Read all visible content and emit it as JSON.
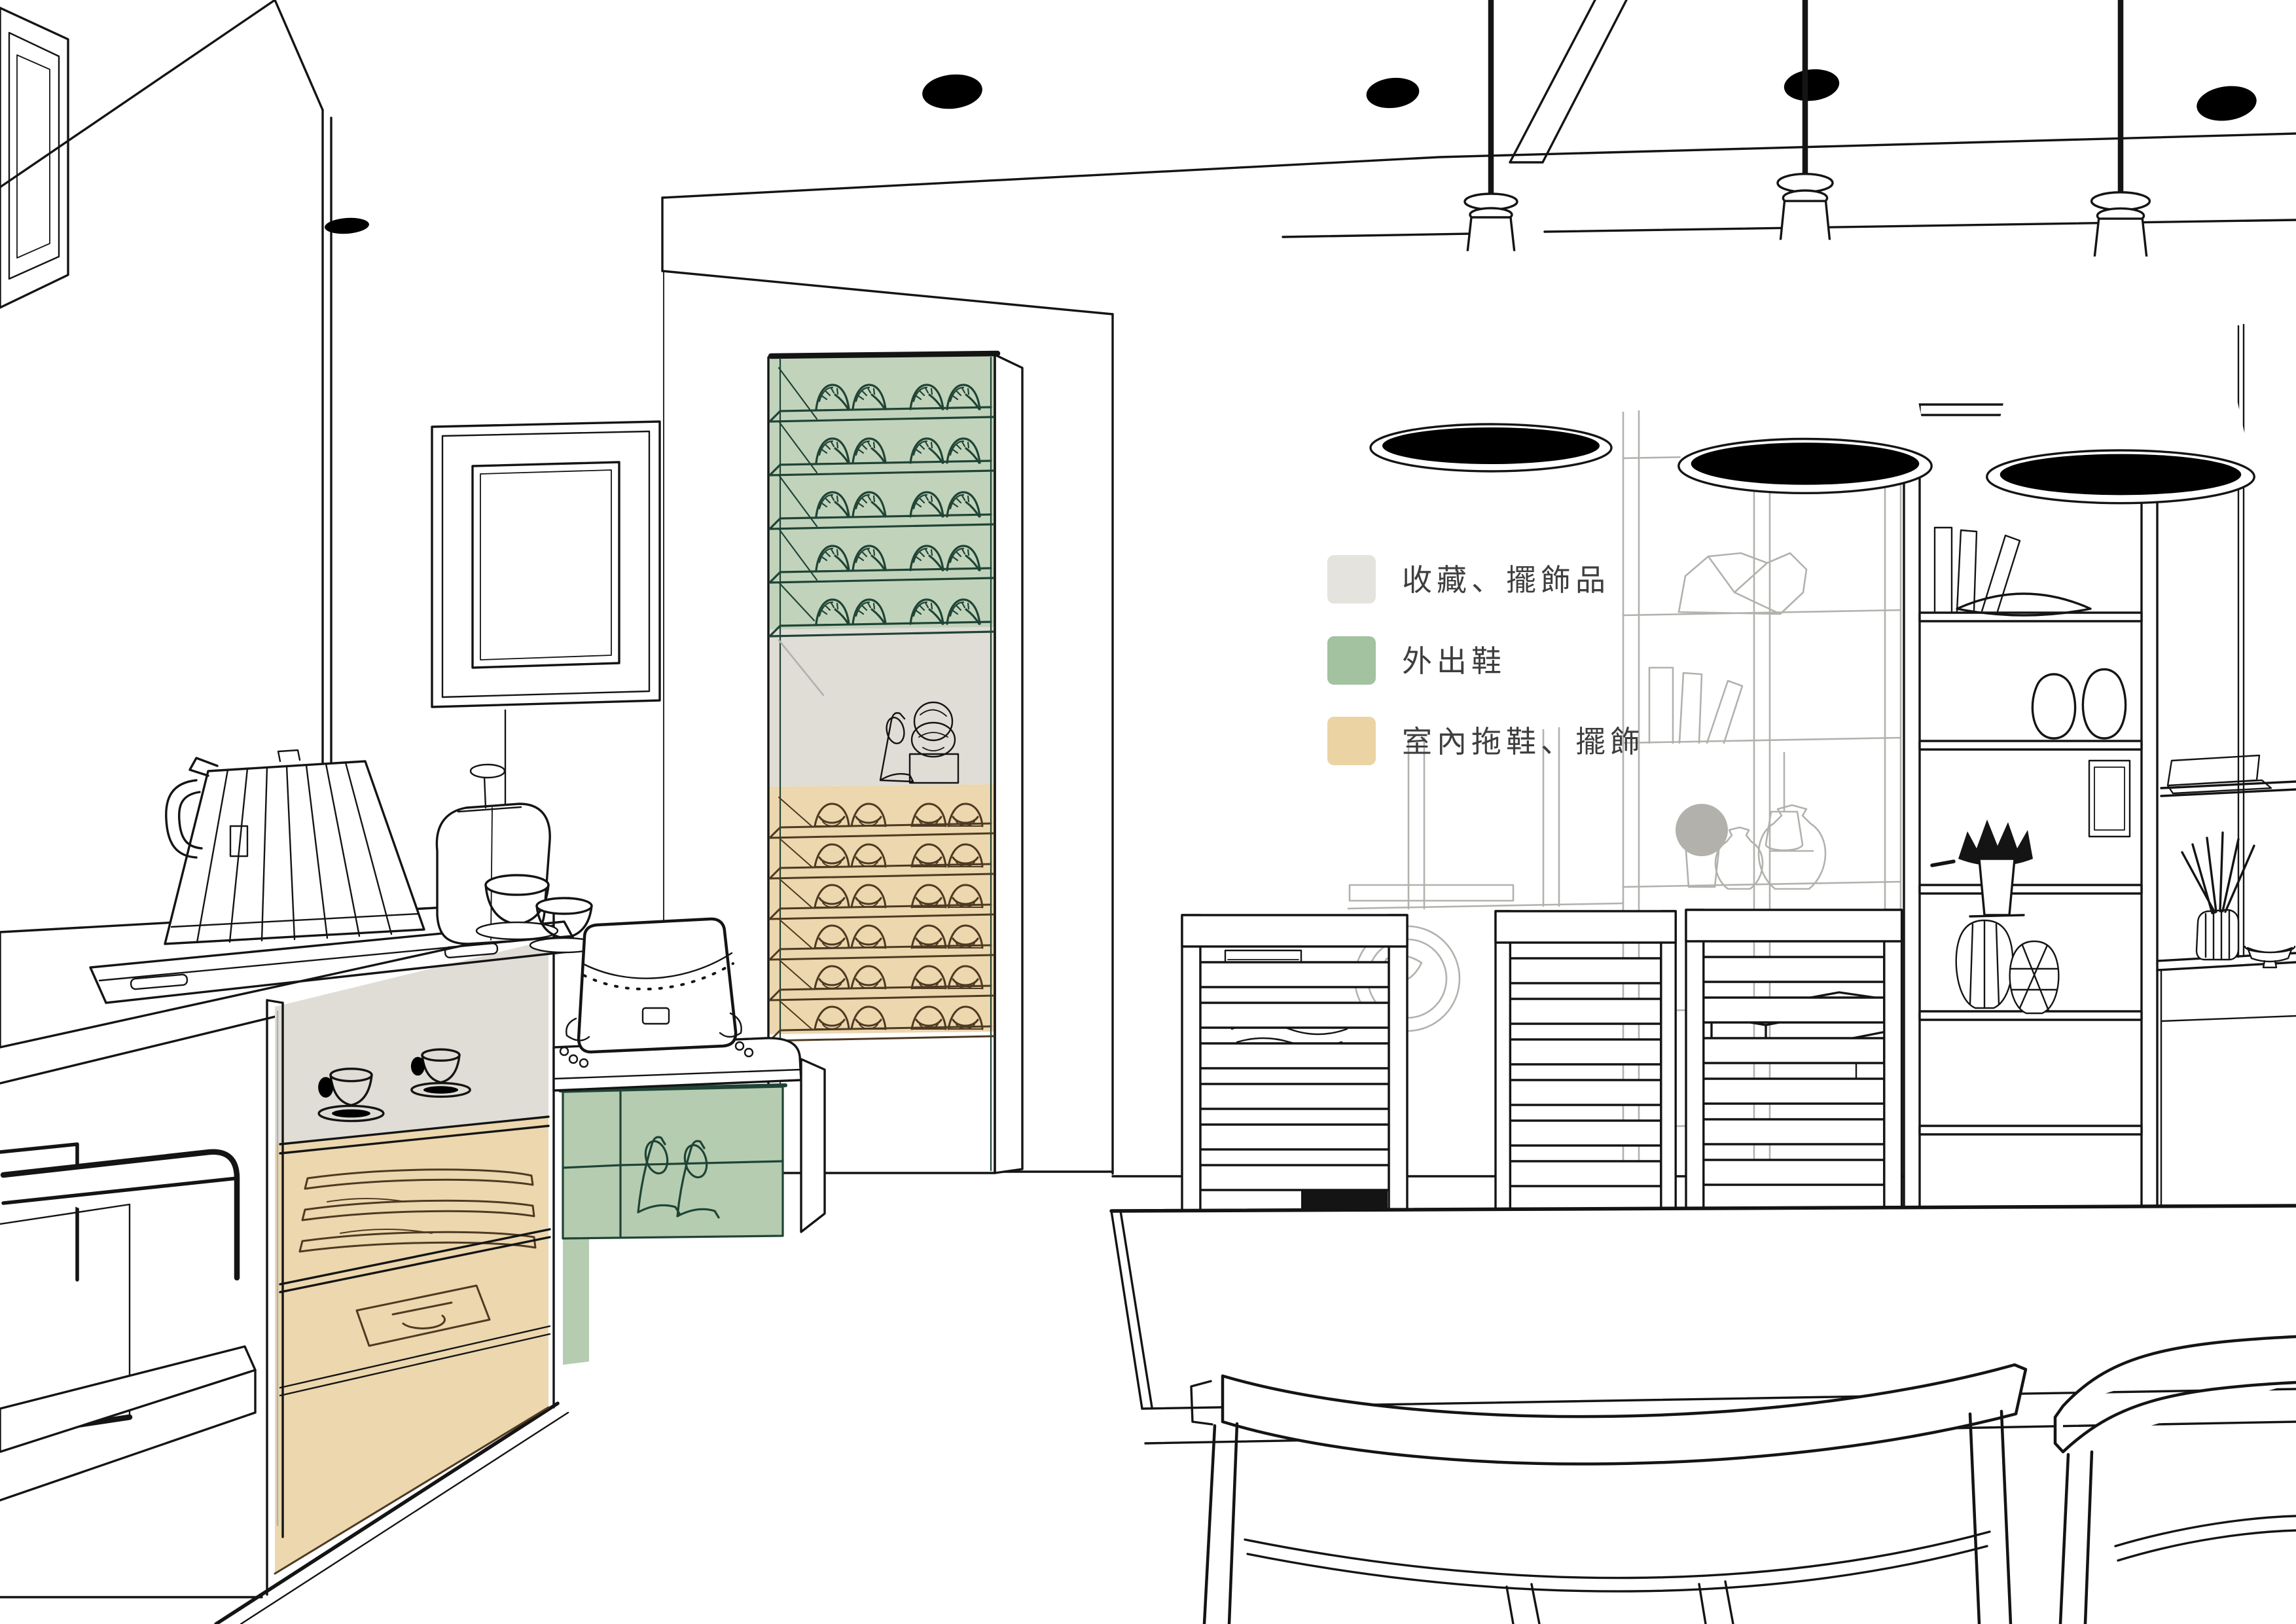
{
  "legend": {
    "items": [
      {
        "id": "collections-decor",
        "label": "收藏、擺飾品",
        "color": "#E4E3DE"
      },
      {
        "id": "outdoor-shoes",
        "label": "外出鞋",
        "color": "#A3C2A0"
      },
      {
        "id": "indoor-slippers",
        "label": "室內拖鞋、擺飾",
        "color": "#EBD3A4"
      }
    ]
  },
  "colors": {
    "line": "#141414",
    "gray": "#B3B1AC",
    "green": "#1F4435",
    "green_fill": "#C2D3BC",
    "tan_fill": "#ECD7AE",
    "brown": "#4E3A22",
    "gray_fill": "#DFDDD6",
    "bench_green": "#B5CCB1",
    "legend_text": "#3E3E3E"
  }
}
